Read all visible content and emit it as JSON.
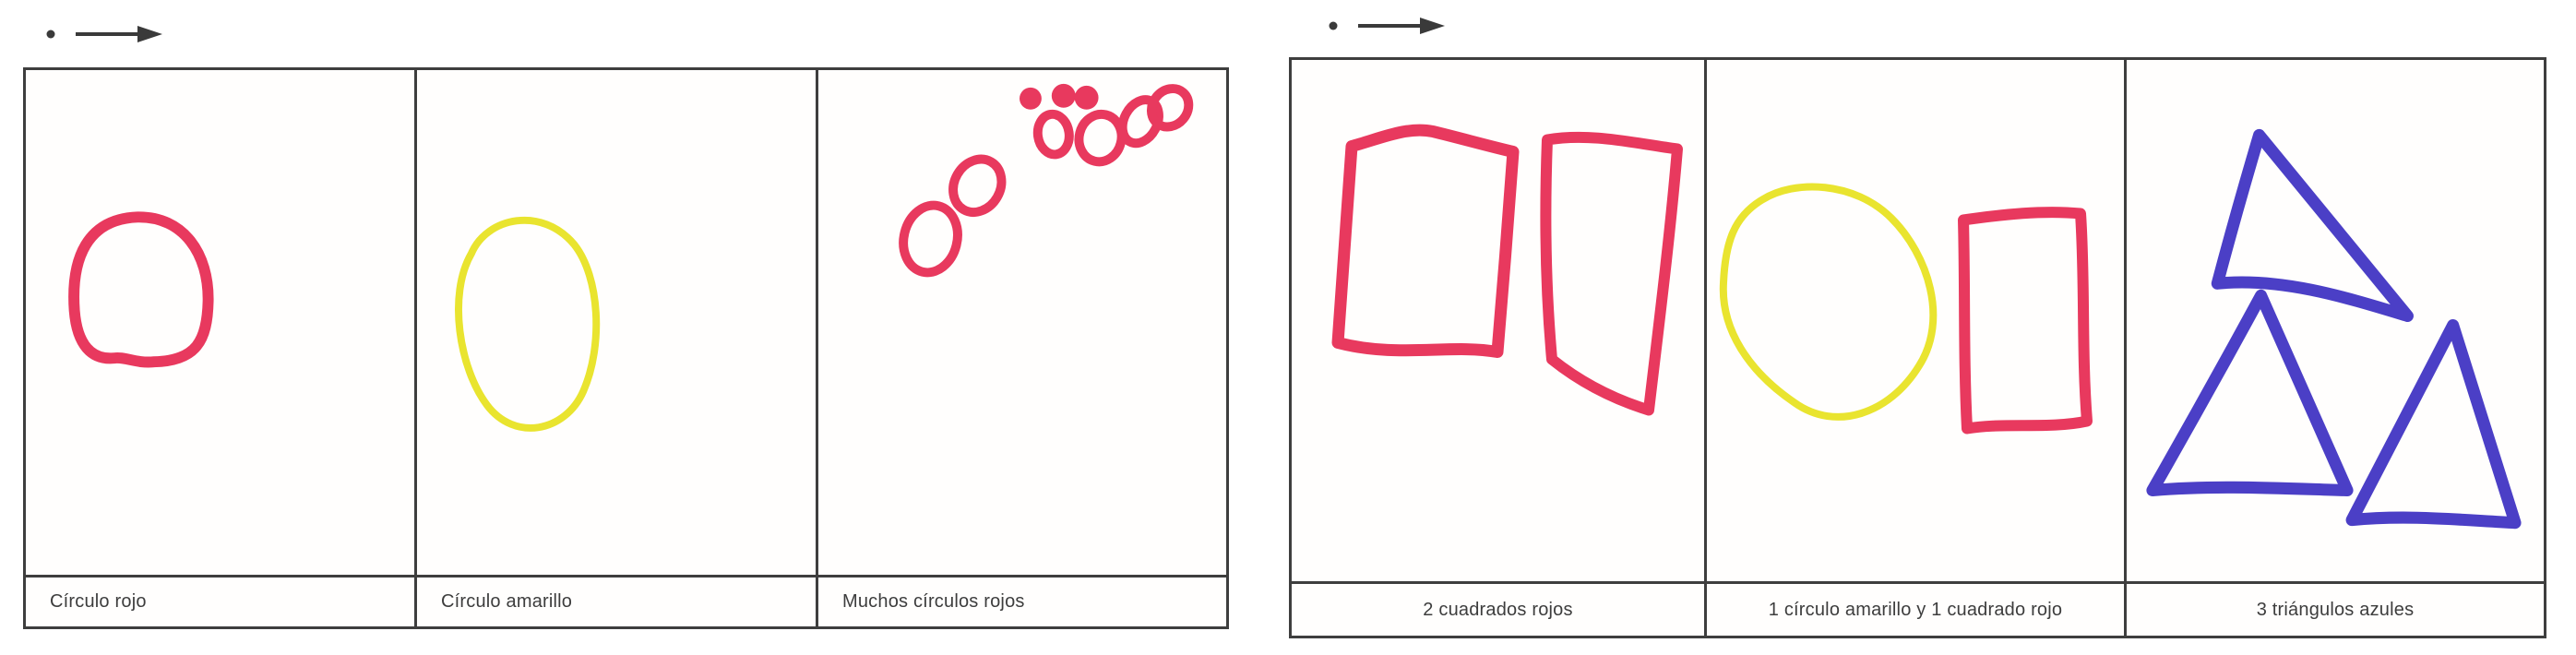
{
  "document_kind": "scanned worksheet with two shape tables",
  "colors": {
    "red": "#e8395e",
    "yellow": "#e9e42f",
    "blue": "#4b3fc6",
    "ink": "#3a3a3a",
    "border": "#3e3e3e"
  },
  "markers": {
    "left": "dot-right-arrow",
    "right": "dot-right-arrow"
  },
  "panels": [
    {
      "id": "left",
      "cells": [
        {
          "caption": "Círculo rojo",
          "shapes": {
            "type": "circle",
            "color_name": "rojo",
            "count": 1
          }
        },
        {
          "caption": "Círculo amarillo",
          "shapes": {
            "type": "circle",
            "color_name": "amarillo",
            "count": 1
          }
        },
        {
          "caption": "Muchos círculos rojos",
          "shapes": {
            "type": "circle",
            "color_name": "rojo",
            "count": 9
          }
        }
      ]
    },
    {
      "id": "right",
      "cells": [
        {
          "caption": "2 cuadrados rojos",
          "shapes": {
            "type": "square",
            "color_name": "rojo",
            "count": 2
          }
        },
        {
          "caption": "1 círculo amarillo y 1 cuadrado rojo",
          "shapes": {
            "type": "circle+square",
            "color_name": "amarillo+rojo",
            "count": 2
          }
        },
        {
          "caption": "3 triángulos azules",
          "shapes": {
            "type": "triangle",
            "color_name": "azul",
            "count": 3
          }
        }
      ]
    }
  ]
}
